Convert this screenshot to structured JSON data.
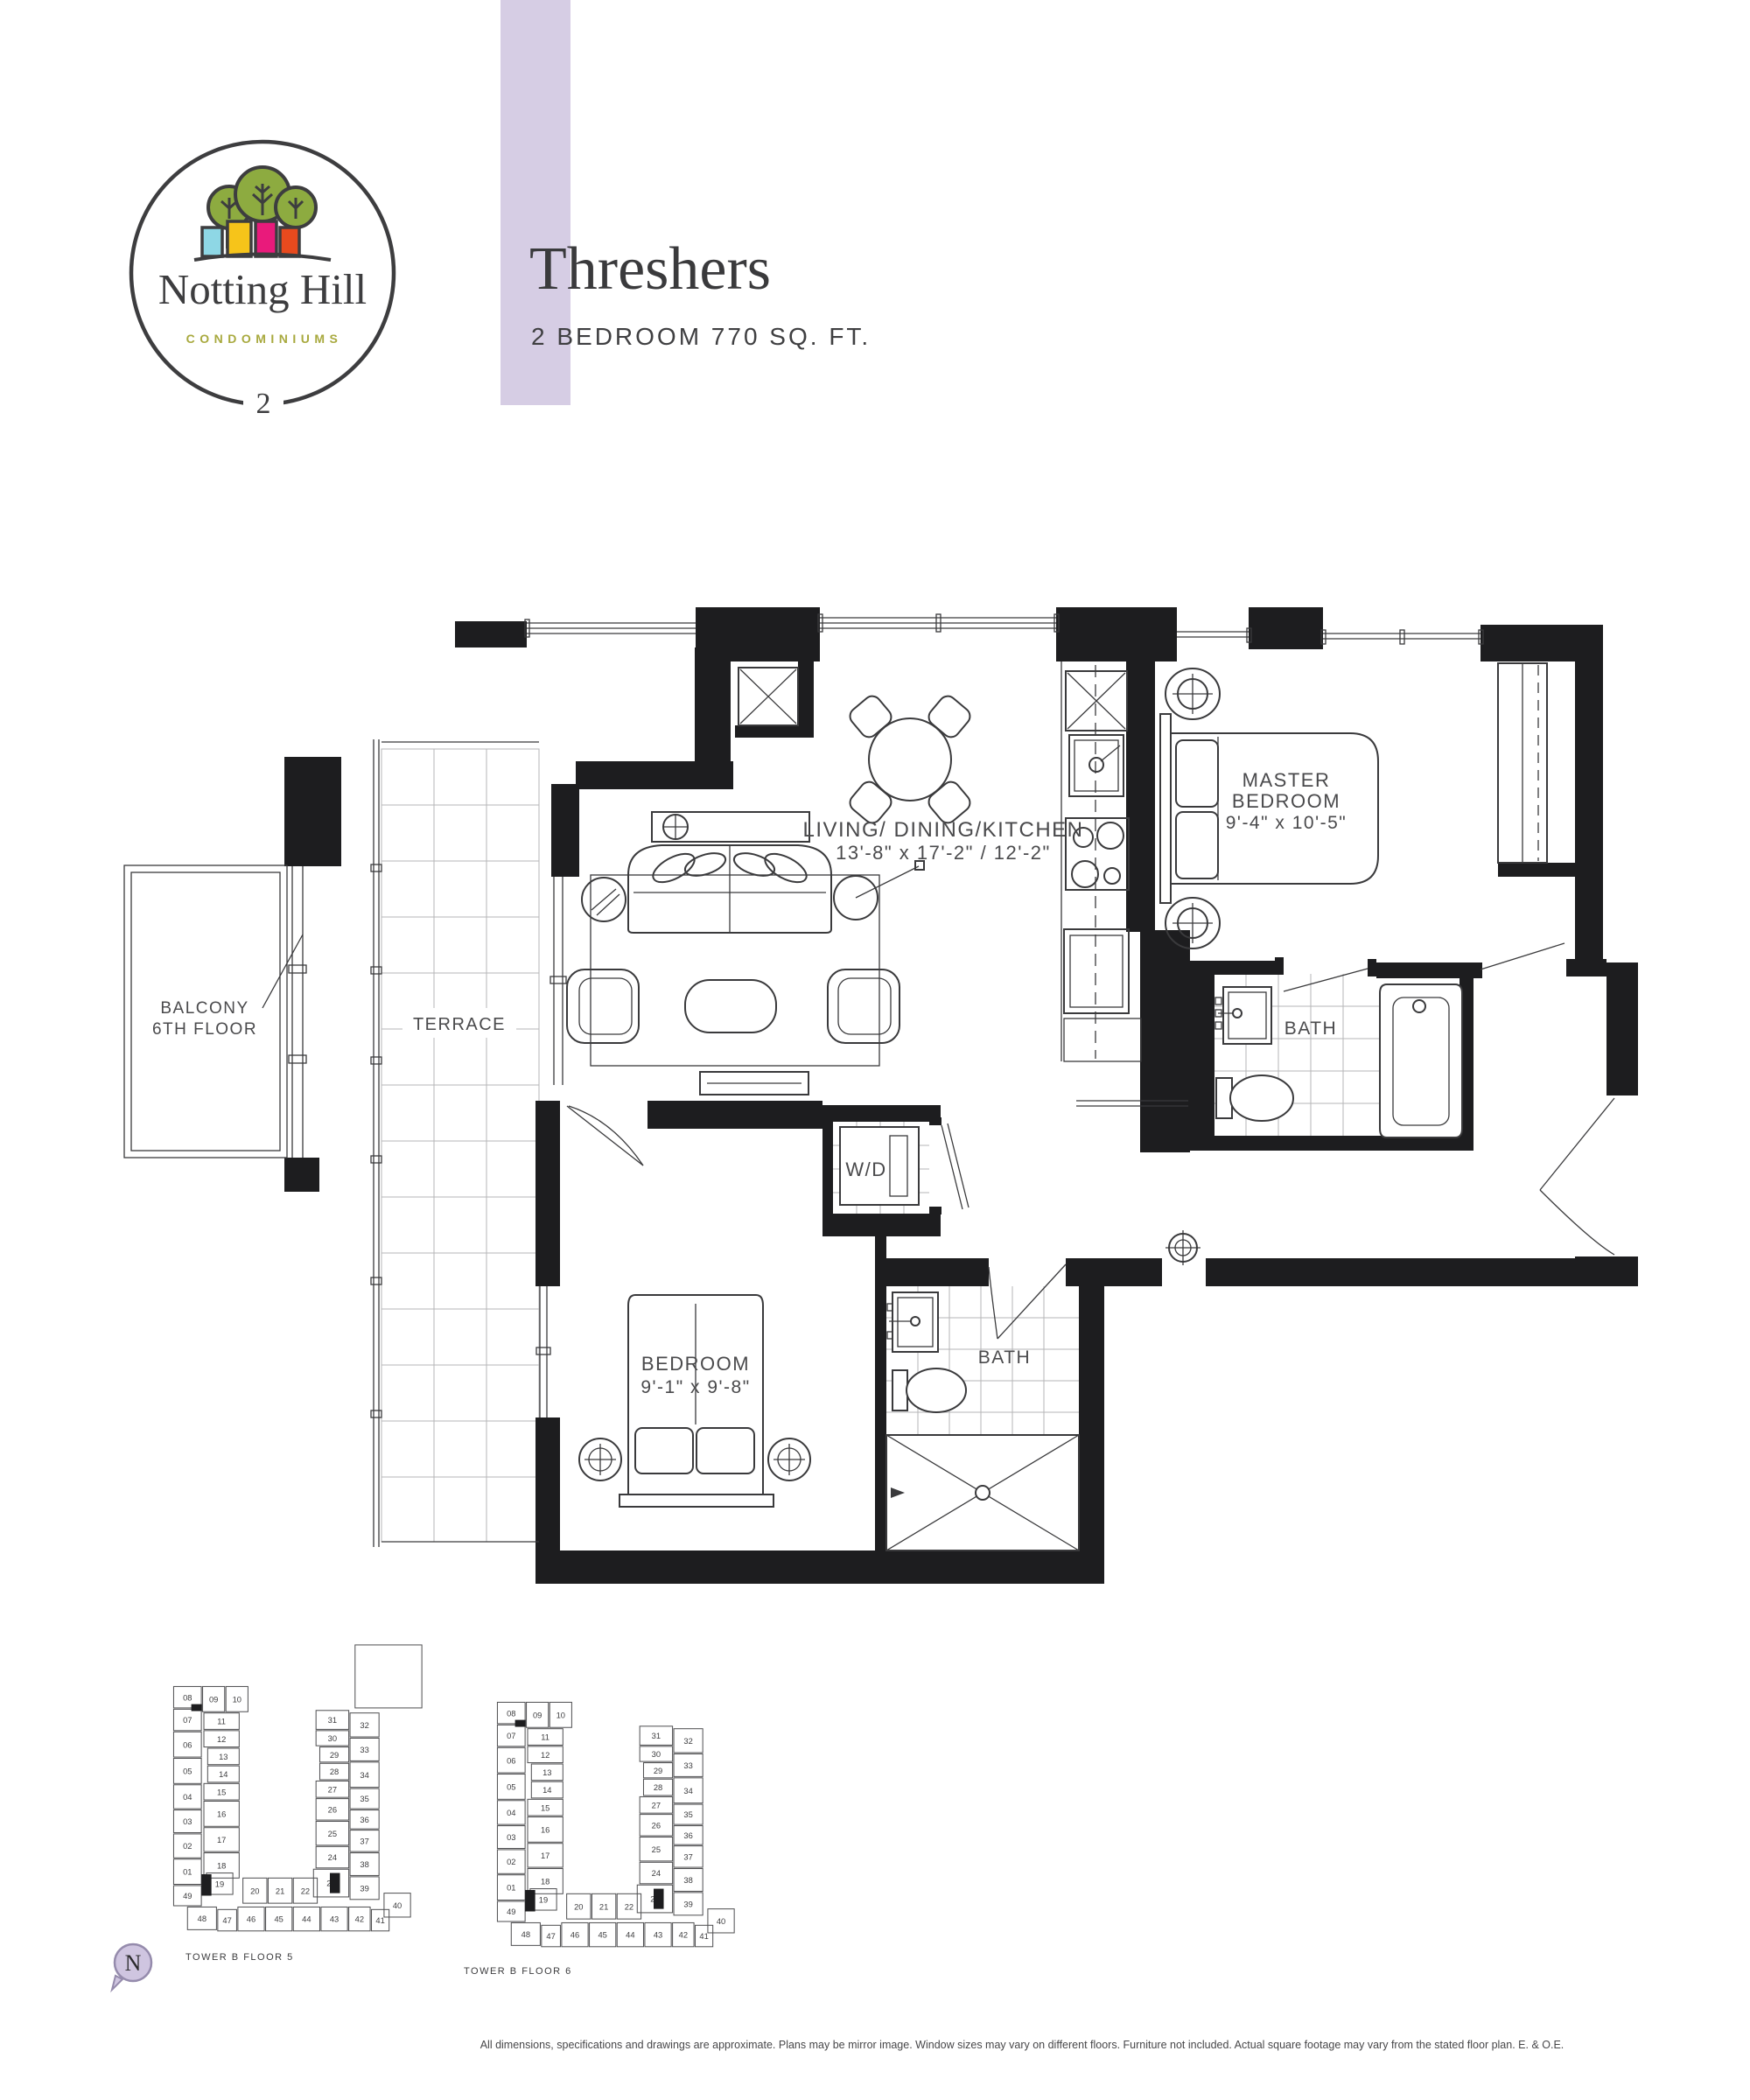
{
  "header": {
    "logo": {
      "name": "Notting Hill",
      "sub": "CONDOMINIUMS",
      "tower": "2"
    },
    "title": "Threshers",
    "subtitle": "2 BEDROOM  770 SQ. FT."
  },
  "plan": {
    "labels": {
      "living": {
        "line1": "LIVING/ DINING/KITCHEN",
        "line2": "13'-8\" x 17'-2\" / 12'-2\""
      },
      "master": {
        "line1": "MASTER",
        "line2": "BEDROOM",
        "line3": "9'-4\" x 10'-5\""
      },
      "bath1": "BATH",
      "bath2": "BATH",
      "bedroom": {
        "line1": "BEDROOM",
        "line2": "9'-1\" x 9'-8\""
      },
      "wd": "W/D",
      "terrace": "TERRACE",
      "balcony": {
        "line1": "BALCONY",
        "line2": "6TH FLOOR"
      }
    }
  },
  "keyplans": [
    {
      "caption": "TOWER B  FLOOR 5",
      "highlight": "08",
      "units": [
        "08",
        "09",
        "10",
        "07",
        "11",
        "12",
        "13",
        "14",
        "15",
        "06",
        "05",
        "04",
        "16",
        "03",
        "17",
        "02",
        "18",
        "01",
        "19",
        "49",
        "20",
        "21",
        "22",
        "31",
        "30",
        "29",
        "28",
        "27",
        "26",
        "25",
        "24",
        "23",
        "32",
        "33",
        "34",
        "35",
        "36",
        "37",
        "38",
        "39",
        "48",
        "47",
        "46",
        "45",
        "44",
        "43",
        "42",
        "41",
        "40"
      ]
    },
    {
      "caption": "TOWER B  FLOOR 6",
      "highlight": "08",
      "units": [
        "08",
        "09",
        "10",
        "07",
        "11",
        "12",
        "13",
        "14",
        "15",
        "06",
        "05",
        "04",
        "16",
        "03",
        "17",
        "02",
        "18",
        "01",
        "19",
        "49",
        "20",
        "21",
        "22",
        "31",
        "30",
        "29",
        "28",
        "27",
        "26",
        "25",
        "24",
        "23",
        "32",
        "33",
        "34",
        "35",
        "36",
        "37",
        "38",
        "39",
        "48",
        "47",
        "46",
        "45",
        "44",
        "43",
        "42",
        "41",
        "40"
      ]
    }
  ],
  "compass": {
    "label": "N"
  },
  "disclaimer": "All dimensions, specifications and drawings are approximate. Plans may be mirror image. Window sizes may vary on different floors. Furniture not included. Actual square footage may vary from the stated floor plan. E. & O.E.",
  "colors": {
    "stripe": "#d6cde4",
    "highlight": "#cdc3dc",
    "olive": "#a8a93e",
    "tree_green": "#8dab40",
    "house_blue": "#8ed7e5",
    "house_yellow": "#f6c41a",
    "house_pink": "#e91a7b",
    "house_orange": "#e84a1e",
    "ink": "#3a3a3c",
    "wall": "#1d1d1f"
  }
}
